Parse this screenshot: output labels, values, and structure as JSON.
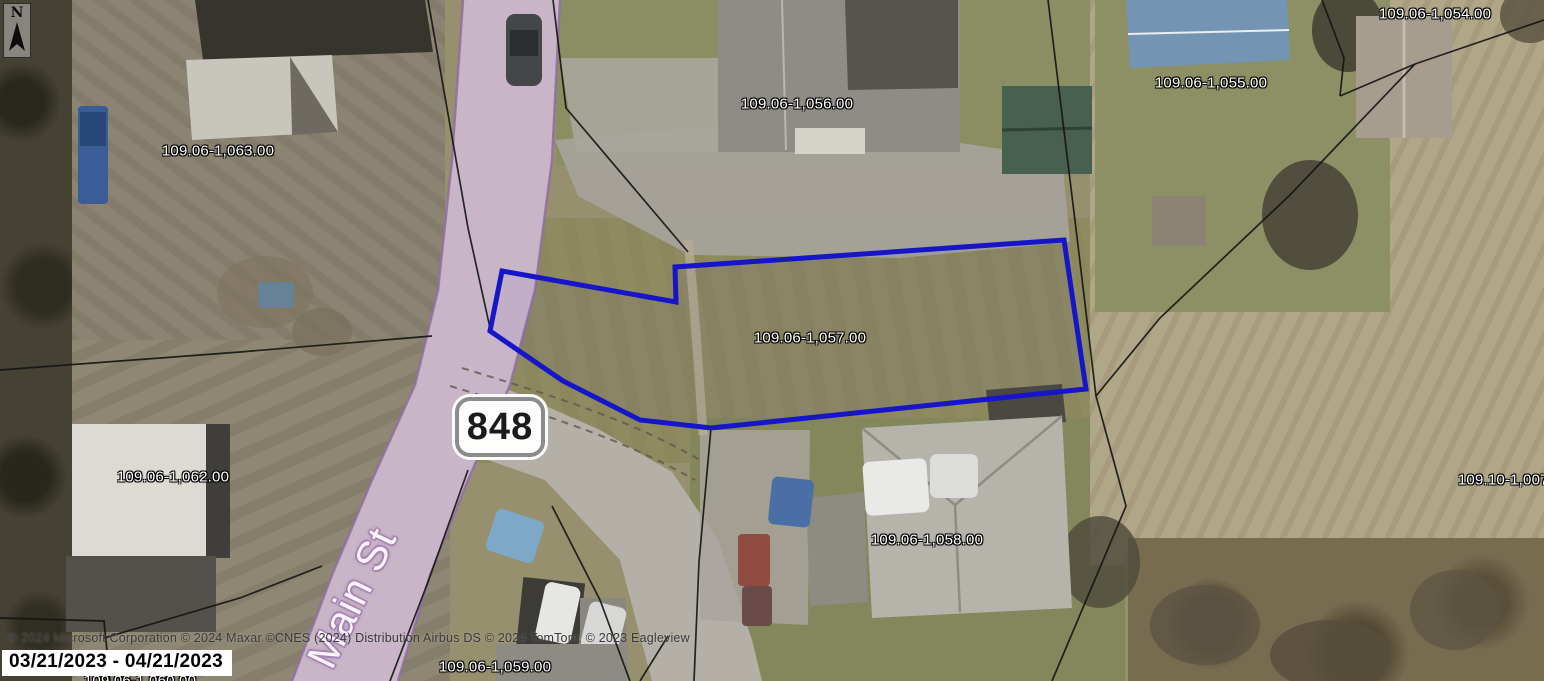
{
  "map": {
    "compass": {
      "label": "N"
    },
    "route_shield": {
      "number": "848"
    },
    "street": {
      "name": "Main St"
    },
    "selected_parcel": {
      "id": "109.06-1,057.00",
      "outline_color": "#1616c8"
    },
    "parcel_labels": [
      {
        "text": "109.06-1,063.00",
        "x": 218,
        "y": 151
      },
      {
        "text": "109.06-1,056.00",
        "x": 797,
        "y": 104
      },
      {
        "text": "109.06-1,055.00",
        "x": 1211,
        "y": 83
      },
      {
        "text": "109.06-1,054.00",
        "x": 1435,
        "y": 14
      },
      {
        "text": "109.06-1,057.00",
        "x": 810,
        "y": 338
      },
      {
        "text": "109.06-1,062.00",
        "x": 173,
        "y": 477
      },
      {
        "text": "109.10-1,007.00",
        "x": 1514,
        "y": 480
      },
      {
        "text": "109.06-1,058.00",
        "x": 927,
        "y": 540
      },
      {
        "text": "109.06-1,059.00",
        "x": 495,
        "y": 667
      },
      {
        "text": "109.06-1,060.00",
        "x": 140,
        "y": 681
      }
    ]
  },
  "footer": {
    "copyright": "© 2024 Microsoft Corporation  © 2024 Maxar ©CNES (2024) Distribution Airbus DS © 2024 TomTom, © 2023 Eagleview",
    "date_range": "03/21/2023 - 04/21/2023"
  }
}
